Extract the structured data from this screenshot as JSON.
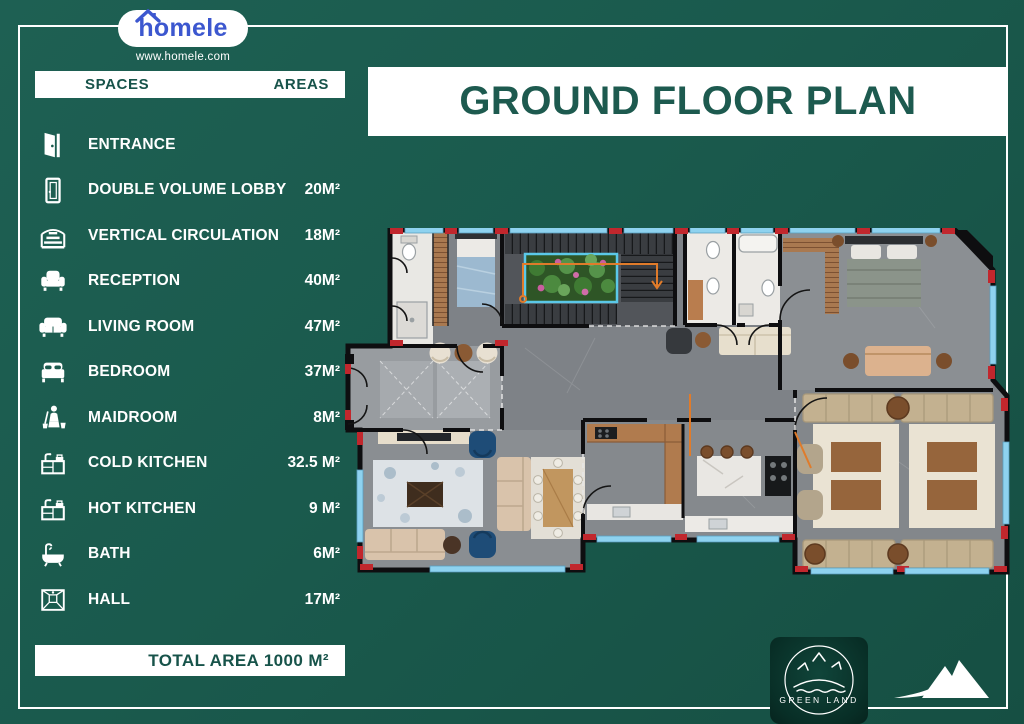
{
  "header": {
    "brand": "homele",
    "website": "www.homele.com"
  },
  "title": "GROUND FLOOR PLAN",
  "legend": {
    "header_spaces": "SPACES",
    "header_areas": "AREAS",
    "rows": [
      {
        "name": "ENTRANCE",
        "area": "",
        "icon": "door-open"
      },
      {
        "name": "DOUBLE VOLUME LOBBY",
        "area": "20M²",
        "icon": "door"
      },
      {
        "name": "VERTICAL CIRCULATION",
        "area": "18M²",
        "icon": "stairs"
      },
      {
        "name": "RECEPTION",
        "area": "40M²",
        "icon": "armchair"
      },
      {
        "name": "LIVING ROOM",
        "area": "47M²",
        "icon": "sofa"
      },
      {
        "name": "BEDROOM",
        "area": "37M²",
        "icon": "bed"
      },
      {
        "name": "MAIDROOM",
        "area": "8M²",
        "icon": "maid"
      },
      {
        "name": "COLD KITCHEN",
        "area": "32.5 M²",
        "icon": "kitchen"
      },
      {
        "name": "HOT KITCHEN",
        "area": "9 M²",
        "icon": "kitchen"
      },
      {
        "name": "BATH",
        "area": "6M²",
        "icon": "bathtub"
      },
      {
        "name": "HALL",
        "area": "17M²",
        "icon": "hall"
      }
    ],
    "total": "TOTAL AREA 1000 M²"
  },
  "footer": {
    "green_land": "GREEN LAND"
  },
  "colors": {
    "background": "#1a5a4d",
    "brand_blue": "#3c57cf",
    "heading_teal": "#1d5a4f",
    "wall_black": "#0e0e10",
    "accent_red": "#c1272d",
    "window_blue": "#8ed2ef",
    "floor_gray": "#84888c",
    "wood": "#a97950",
    "planter_green": "#3f7a33",
    "flower_pink": "#c95f9f",
    "railing_orange": "#e07b2a"
  }
}
